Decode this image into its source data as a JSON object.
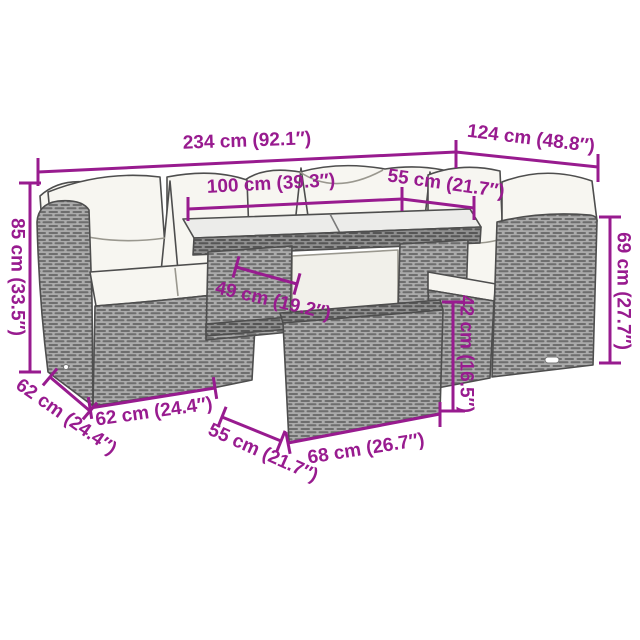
{
  "diagram": {
    "kind": "furniture-dimension-diagram",
    "unit_format": "cm (inches)"
  },
  "colors": {
    "dimension": "#981B8F",
    "outline": "#4E4E4E",
    "rattan_light": "#A9A9A9",
    "rattan_dark": "#6E6E6E",
    "cushion": "#F7F6F1",
    "background": "#FFFFFF"
  },
  "dimensions": [
    {
      "id": "overall-width",
      "label": "234 cm (92.1″)"
    },
    {
      "id": "overall-depth",
      "label": "124 cm (48.8″)"
    },
    {
      "id": "table-length",
      "label": "100 cm (39.3″)"
    },
    {
      "id": "table-depth",
      "label": "55 cm (21.7″)"
    },
    {
      "id": "back-height",
      "label": "85 cm (33.5″)"
    },
    {
      "id": "arm-height",
      "label": "69 cm (27.7″)"
    },
    {
      "id": "seat-depth",
      "label": "49 cm (19.2″)"
    },
    {
      "id": "table-height",
      "label": "42 cm (16.5″)"
    },
    {
      "id": "sofa-side-depth",
      "label": "62 cm (24.4″)"
    },
    {
      "id": "sofa-width",
      "label": "62 cm (24.4″)"
    },
    {
      "id": "ottoman-depth",
      "label": "55 cm (21.7″)"
    },
    {
      "id": "ottoman-width",
      "label": "68 cm (26.7″)"
    }
  ]
}
